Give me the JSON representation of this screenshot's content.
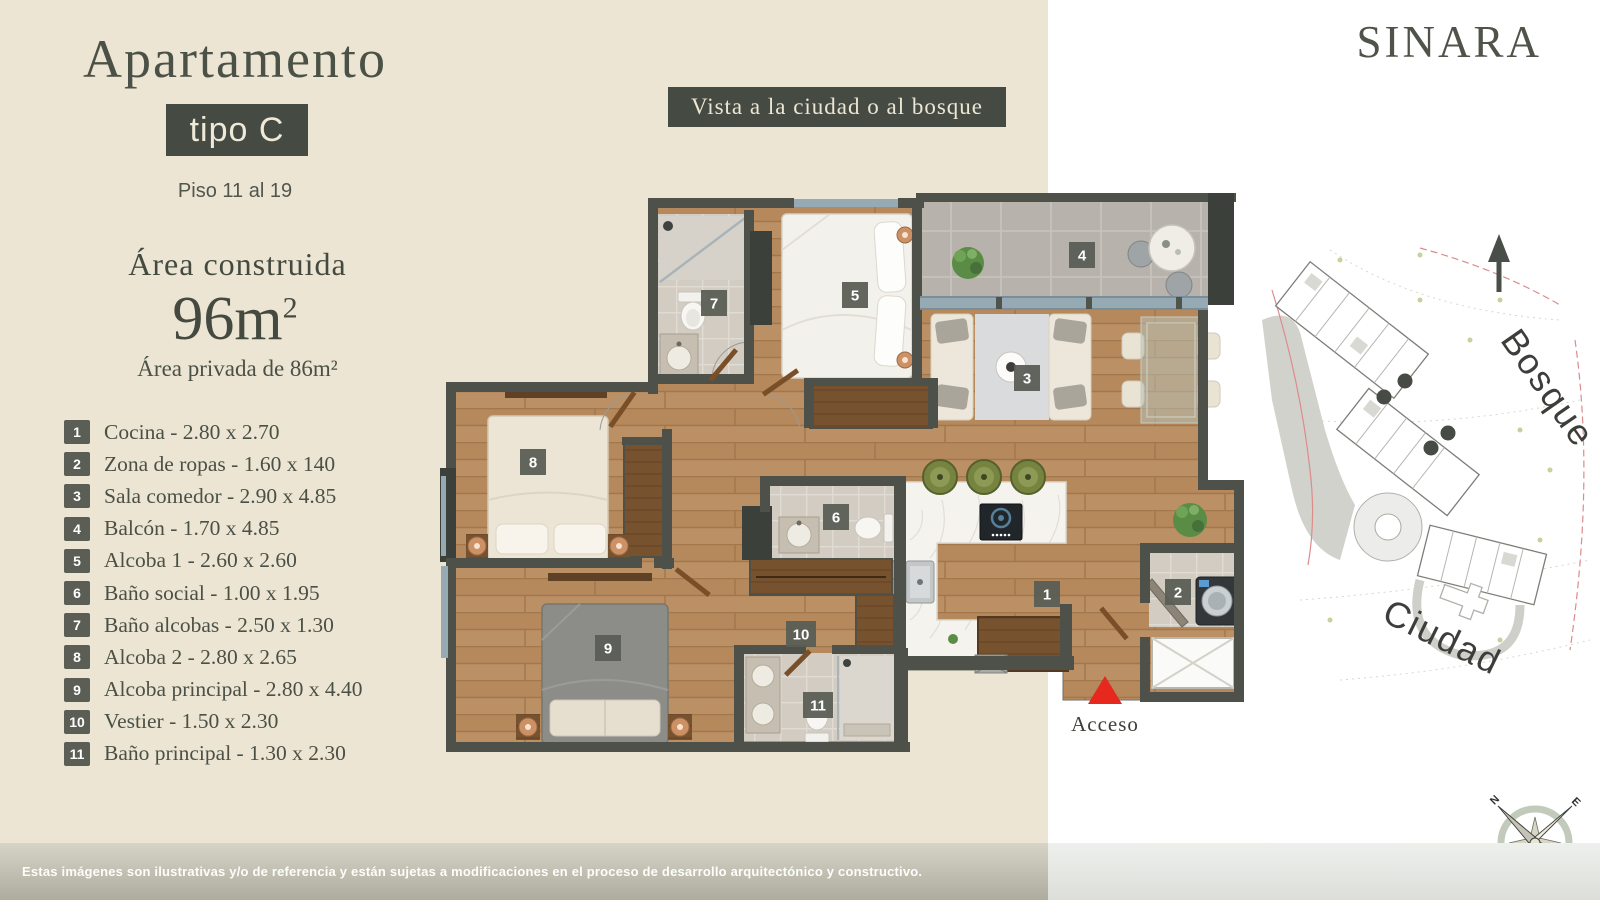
{
  "brand": "SINARA",
  "header": {
    "title": "Apartamento",
    "type_badge": "tipo C",
    "floor_range": "Piso 11 al 19"
  },
  "area": {
    "built_label": "Área construida",
    "built_value": "96m",
    "built_sup": "2",
    "private": "Área privada de 86m²"
  },
  "view_badge": "Vista a la ciudad o al bosque",
  "legend": {
    "separator": " - "
  },
  "rooms": [
    {
      "num": "1",
      "name": "Cocina",
      "dims": "2.80 x 2.70",
      "plan_x": 1047,
      "plan_y": 594
    },
    {
      "num": "2",
      "name": "Zona de ropas",
      "dims": "1.60 x 140",
      "plan_x": 1178,
      "plan_y": 592
    },
    {
      "num": "3",
      "name": "Sala comedor",
      "dims": "2.90 x 4.85",
      "plan_x": 1027,
      "plan_y": 378
    },
    {
      "num": "4",
      "name": "Balcón",
      "dims": "1.70 x 4.85",
      "plan_x": 1082,
      "plan_y": 255
    },
    {
      "num": "5",
      "name": "Alcoba 1",
      "dims": "2.60 x 2.60",
      "plan_x": 855,
      "plan_y": 295
    },
    {
      "num": "6",
      "name": "Baño social",
      "dims": "1.00 x 1.95",
      "plan_x": 836,
      "plan_y": 517
    },
    {
      "num": "7",
      "name": "Baño alcobas",
      "dims": "2.50 x 1.30",
      "plan_x": 714,
      "plan_y": 303
    },
    {
      "num": "8",
      "name": "Alcoba 2",
      "dims": "2.80 x 2.65",
      "plan_x": 533,
      "plan_y": 462
    },
    {
      "num": "9",
      "name": "Alcoba principal",
      "dims": "2.80 x 4.40",
      "plan_x": 608,
      "plan_y": 648
    },
    {
      "num": "10",
      "name": "Vestier",
      "dims": "1.50 x 2.30",
      "plan_x": 801,
      "plan_y": 634
    },
    {
      "num": "11",
      "name": "Baño principal",
      "dims": "1.30 x 2.30",
      "plan_x": 818,
      "plan_y": 705
    }
  ],
  "plan": {
    "access_label": "Acceso"
  },
  "site_plan": {
    "forest_label": "Bosque",
    "city_label": "Ciudad"
  },
  "compass": {
    "points": [
      "N",
      "E",
      "S",
      "O"
    ]
  },
  "footer": "Estas imágenes son ilustrativas y/o de referencia y están sujetas a modificaciones en el proceso de desarrollo arquitectónico y constructivo.",
  "colors": {
    "background_left": "#ece5d3",
    "background_right": "#ffffff",
    "badge_dark": "#454a43",
    "text_dark": "#4b5046",
    "accent_red": "#e6281e",
    "wood": "#b5895c",
    "wall": "#4d514a"
  }
}
